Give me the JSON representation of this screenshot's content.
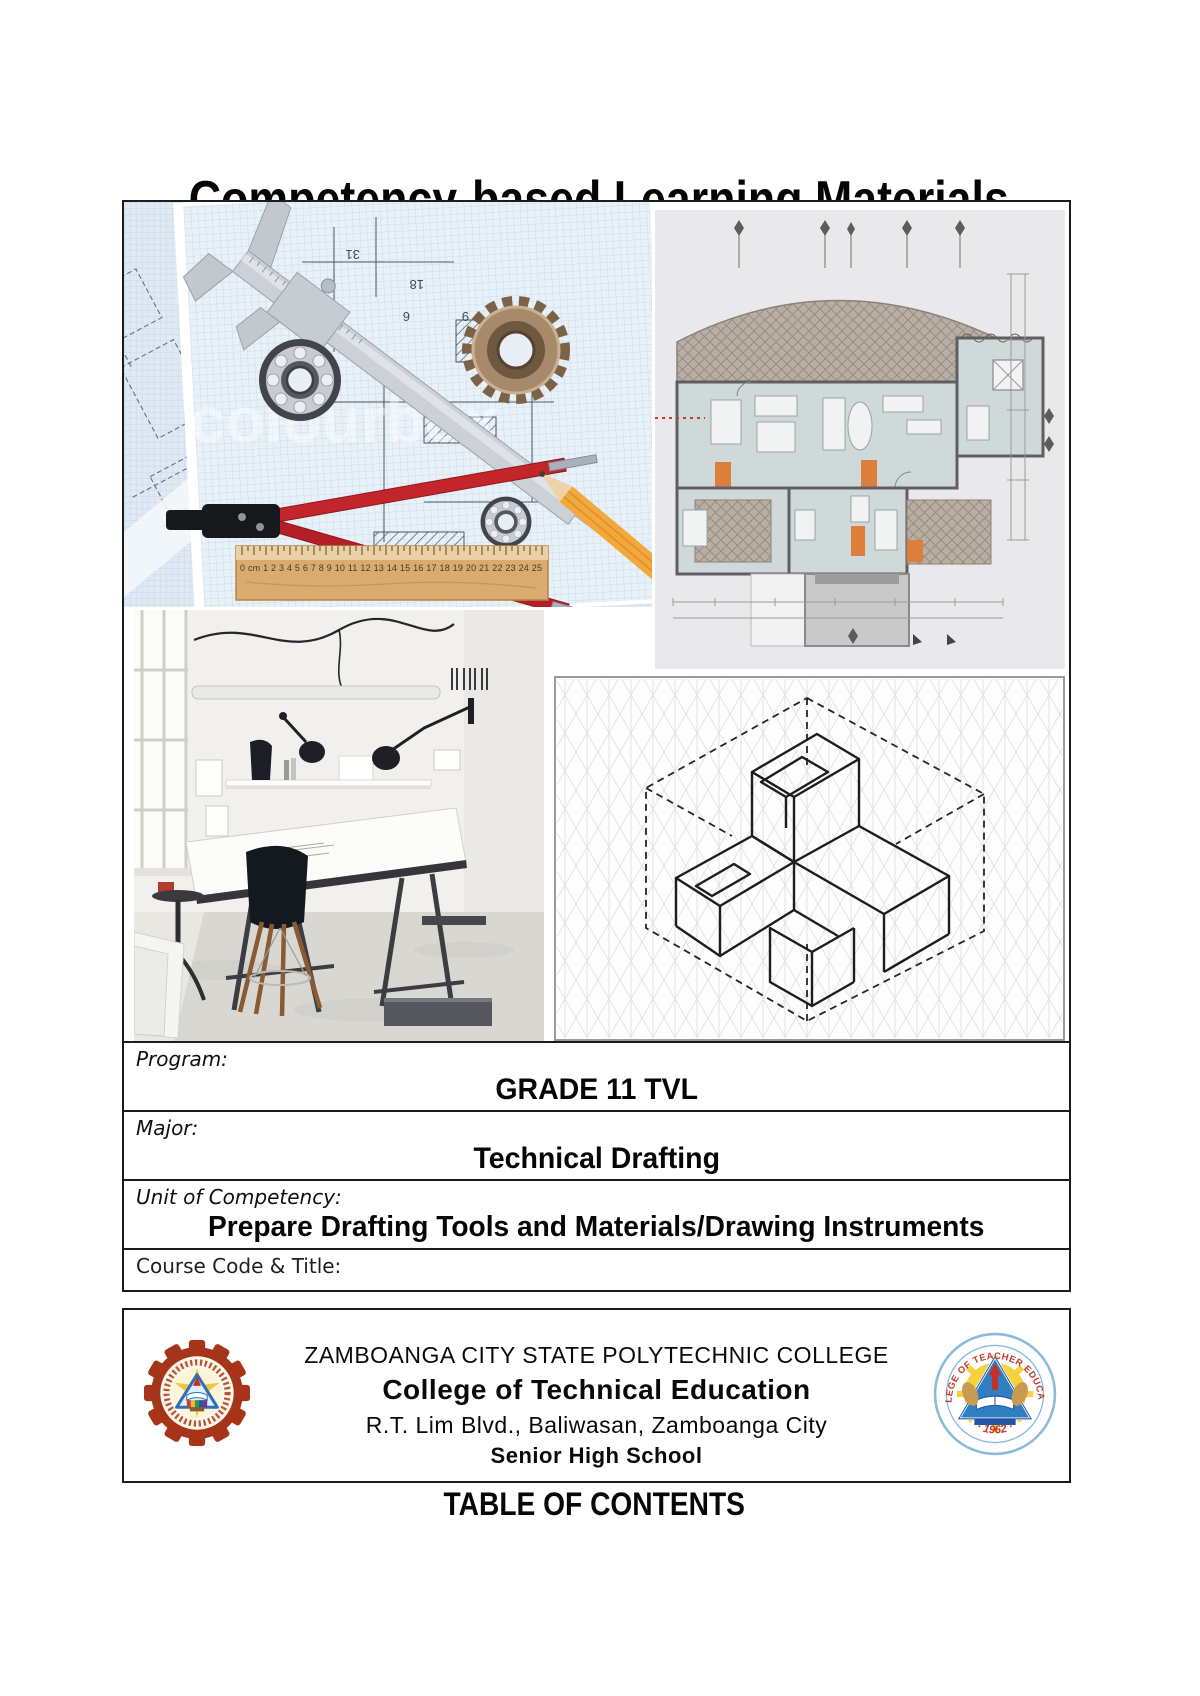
{
  "page": {
    "title": "Competency-based Learning Materials",
    "toc_heading": "TABLE OF CONTENTS"
  },
  "collage": {
    "watermark": "colourbox",
    "ruler_scale": "0 cm 1 2 3 4 5 6 7 8 9 10 11 12 13 14 15 16 17 18 19 20 21 22 23 24 25",
    "blueprint_numbers": [
      "31",
      "18",
      "6",
      "9",
      "545"
    ]
  },
  "info_table": {
    "rows": [
      {
        "label": "Program:",
        "value": "GRADE 11 TVL"
      },
      {
        "label": "Major:",
        "value": "Technical Drafting"
      },
      {
        "label": "Unit of Competency:",
        "value": "Prepare Drafting Tools and Materials/Drawing Instruments"
      },
      {
        "label": "Course Code & Title:",
        "value": ""
      }
    ]
  },
  "footer": {
    "institution": "ZAMBOANGA CITY STATE POLYTECHNIC COLLEGE",
    "college": "College of Technical Education",
    "address": "R.T. Lim Blvd., Baliwasan, Zamboanga City",
    "school_level": "Senior High School",
    "right_seal": {
      "arc_text": "COLLEGE OF TEACHER EDUCATION",
      "year_display": "· 1962 ·"
    }
  },
  "colors": {
    "border": "#1c1c1c",
    "seal_maroon": "#a63418",
    "seal_blue_ring": "#8abbdc",
    "seal_red_text": "#c0392b",
    "plan_orange": "#dd7f3c"
  }
}
